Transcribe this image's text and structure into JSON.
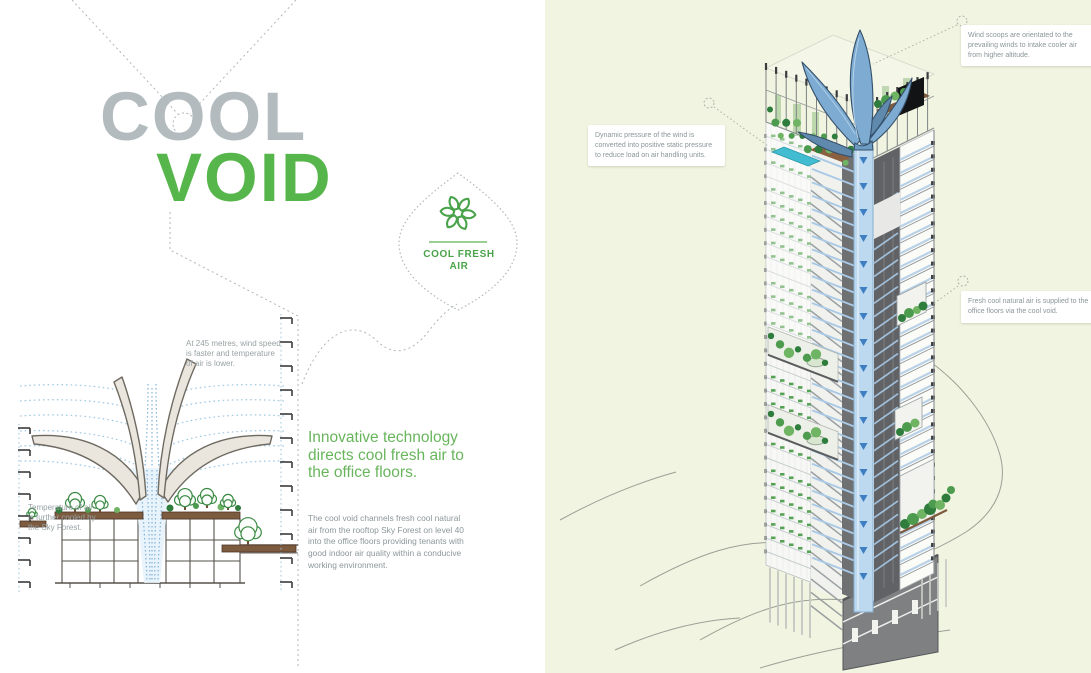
{
  "title": {
    "line1": "COOL",
    "line2": "VOID"
  },
  "badge": {
    "icon": "leaf-cluster-icon",
    "label": "COOL FRESH\nAIR"
  },
  "intro": {
    "heading": "Innovative technology\ndirects cool fresh air to\nthe office floors.",
    "body": "The cool void channels fresh cool natural\nair from the rooftop Sky Forest on level 40\ninto the office floors providing tenants with\ngood indoor air quality within a conducive\nworking environment."
  },
  "diagram": {
    "annotation_wind": "At 245 metres, wind speed\nis faster and temperature\nof air is lower.",
    "annotation_temp": "Temperature of air\nis further cooled by\nthe Sky Forest."
  },
  "callouts": [
    {
      "id": "wind-scoops",
      "text": "Wind scoops are orientated to the\nprevailing winds to intake cooler air\nfrom higher altitude."
    },
    {
      "id": "dynamic-pressure",
      "text": "Dynamic pressure of the wind is\nconverted into positive static pressure\nto reduce load on air handling units."
    },
    {
      "id": "fresh-air-supply",
      "text": "Fresh cool natural air is supplied to the\noffice floors via the cool void."
    }
  ],
  "colors": {
    "panel_bg": "#f1f4e0",
    "title_gray": "#b4bbbe",
    "brand_green": "#57b64b",
    "heading_green": "#68b55c",
    "body_gray": "#8c979a",
    "annotation_gray": "#98a2a4",
    "callout_text": "#8b9699",
    "badge_green": "#4aa34a",
    "dotted_gray": "#b2b7b9",
    "stream_blue": "#a5cbe5",
    "sail_tan": "#eae6dd",
    "sail_edge": "#6e6a61",
    "scoop_blue": "#7dabd2",
    "scoop_edge": "#35506a",
    "void_blue": "#bcd9f0",
    "duct_blue": "#a9c9e6",
    "arrow_blue": "#3f7fc1",
    "core_dark": "#606265",
    "core_mid": "#6e7072",
    "slab_gray": "#8f9496",
    "facade_line": "#c6cdcf",
    "glass_band": "#b9d2e8",
    "tree_dark": "#2e7d3c",
    "tree_mid": "#4d9b4f",
    "tree_light": "#6fb463",
    "pool_teal": "#42bcd0",
    "deck_brown": "#7d5b3f",
    "ground_line": "#9b9f95"
  }
}
